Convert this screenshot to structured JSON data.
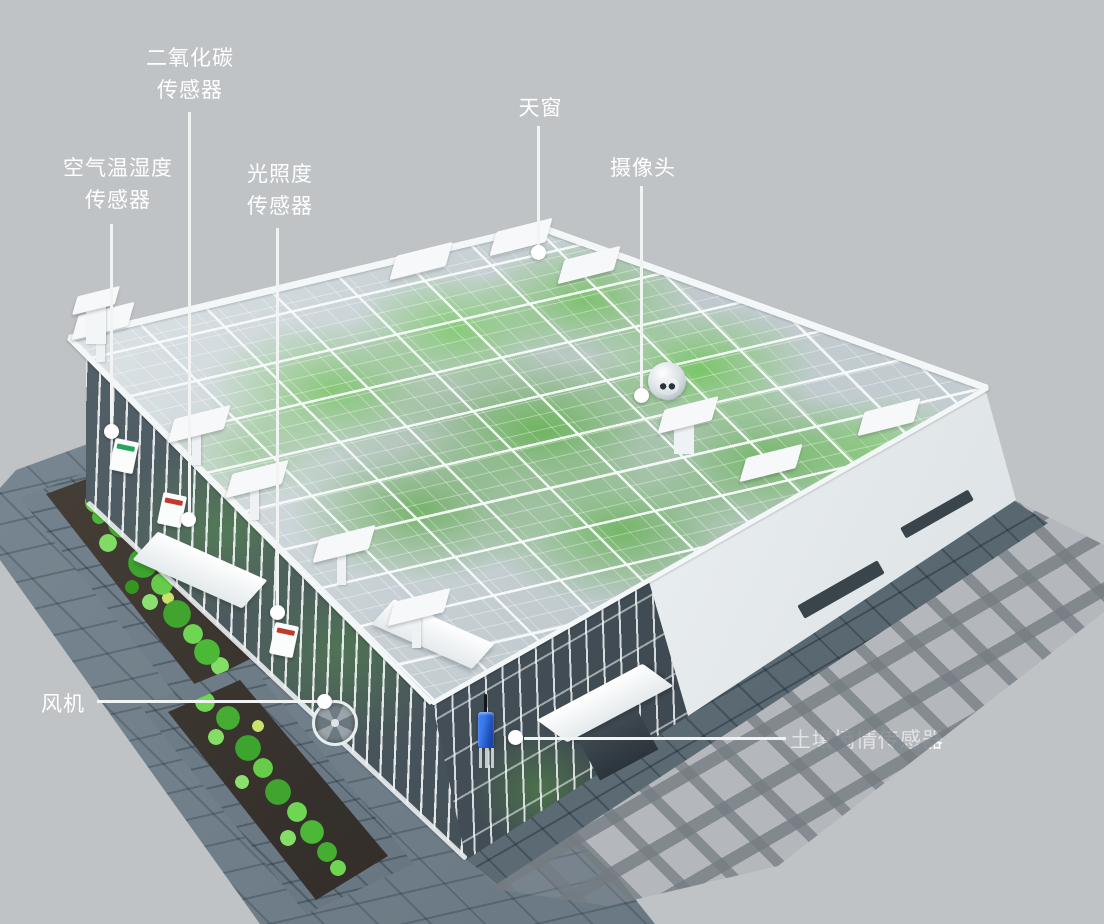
{
  "colors": {
    "background": "#c0c3c6",
    "label_text": "#ffffff",
    "leader_line": "#f2f4f4",
    "marker_dot": "#ffffff",
    "frame_white": "#f4f7f8",
    "crop_green": "#4cb52c",
    "pond_water": "#48403a",
    "paving_tile": "#71808b",
    "walkway_dark": "#5e6c76",
    "facade_white": "#eff2f4",
    "glass_dark": "#3c474e",
    "soil_sensor_blue": "#2a63d4",
    "sensor_stripe_red": "#c0392b",
    "sensor_stripe_green": "#27a35a"
  },
  "callouts": {
    "co2": {
      "label": "二氧化碳\n传感器"
    },
    "air_temp_humidity": {
      "label": "空气温湿度\n传感器"
    },
    "light": {
      "label": "光照度\n传感器"
    },
    "skylight": {
      "label": "天窗"
    },
    "camera": {
      "label": "摄像头"
    },
    "fan": {
      "label": "风机"
    },
    "soil_moisture": {
      "label": "土壤墒情传感器"
    }
  }
}
